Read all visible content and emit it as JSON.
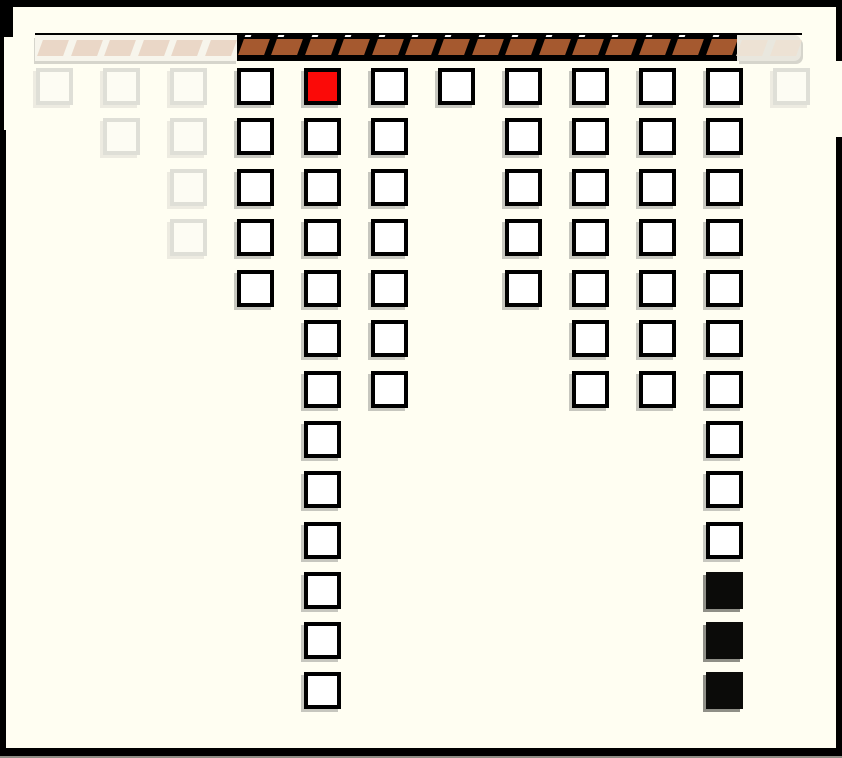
{
  "meta": {
    "description": "falling-blocks game board with brick ceiling, ghosted edge columns, one red block and three black blocks",
    "window_width": 842,
    "window_height": 758
  },
  "colors": {
    "background": "#FFFEF2",
    "frame": "#000000",
    "frame_bottom_edge": "#8E8E86",
    "bar_top_line": "#000000",
    "bar_background": "#000000",
    "brick": "#A5592F",
    "brick_highlight": "#FFFFFF",
    "ghost_bar_backing_left": "#F7F5EC",
    "ghost_bar_backing_right": "#E9E7DE",
    "ghost_slat_left": "#EAD7C7",
    "ghost_slat_right": "#EDE2D4",
    "ghost_shadow": "#D6D5CC",
    "block_border": "#000000",
    "block_white": "#FFFFFF",
    "block_red": "#FB0A08",
    "block_black": "#0B0B09",
    "ghost_block_border": "#DFDFD7",
    "ghost_block_fill": "#FDFCF3",
    "ghost_cell_shadow": "#EDEBE1",
    "block_shadow": "#C7C7BF",
    "black_block_shadow": "#8F8F87"
  },
  "bar": {
    "top_line": {
      "x": 35,
      "y": 33,
      "width": 767,
      "height": 2
    },
    "sections": [
      {
        "name": "brick-bar-ghost-left",
        "kind": "ghost-left",
        "x": 35,
        "y": 35,
        "width": 202,
        "height": 26,
        "slats": 6,
        "pitch": 33.5,
        "inset": 5
      },
      {
        "name": "brick-bar-solid",
        "kind": "solid",
        "x": 237,
        "y": 33,
        "width": 500,
        "height": 28,
        "slats": 15,
        "pitch": 33.4,
        "inset": 4
      },
      {
        "name": "brick-bar-ghost-right",
        "kind": "ghost-right",
        "x": 737,
        "y": 35,
        "width": 64,
        "height": 26,
        "slats": 2,
        "pitch": 33.5,
        "inset": 2
      }
    ]
  },
  "board": {
    "block_size": 37,
    "row_y": [
      68,
      118,
      169,
      219,
      270,
      320,
      371,
      421,
      471,
      522,
      572,
      622,
      672
    ],
    "columns": [
      {
        "x": 36,
        "ghost": true,
        "rows": [
          1
        ]
      },
      {
        "x": 103,
        "ghost": true,
        "rows": [
          1,
          2
        ]
      },
      {
        "x": 170,
        "ghost": true,
        "rows": [
          1,
          2,
          3,
          4
        ]
      },
      {
        "x": 237,
        "ghost": false,
        "rows": [
          1,
          2,
          3,
          4,
          5
        ]
      },
      {
        "x": 304,
        "ghost": false,
        "rows": [
          1,
          2,
          3,
          4,
          5,
          6,
          7,
          8,
          9,
          10,
          11,
          12,
          13
        ],
        "special": {
          "1": "red"
        }
      },
      {
        "x": 371,
        "ghost": false,
        "rows": [
          1,
          2,
          3,
          4,
          5,
          6,
          7
        ]
      },
      {
        "x": 438,
        "ghost": false,
        "rows": [
          1
        ]
      },
      {
        "x": 505,
        "ghost": false,
        "rows": [
          1,
          2,
          3,
          4,
          5
        ]
      },
      {
        "x": 572,
        "ghost": false,
        "rows": [
          1,
          2,
          3,
          4,
          5,
          6,
          7
        ]
      },
      {
        "x": 639,
        "ghost": false,
        "rows": [
          1,
          2,
          3,
          4,
          5,
          6,
          7
        ]
      },
      {
        "x": 706,
        "ghost": false,
        "rows": [
          1,
          2,
          3,
          4,
          5,
          6,
          7,
          8,
          9,
          10,
          11,
          12,
          13
        ],
        "special": {
          "11": "black",
          "12": "black",
          "13": "black"
        }
      },
      {
        "x": 773,
        "ghost": true,
        "rows": [
          1
        ]
      }
    ]
  },
  "frame": {
    "pieces": [
      {
        "name": "frame-top",
        "x": 0,
        "y": 0,
        "w": 842,
        "h": 7
      },
      {
        "name": "frame-left-corner",
        "x": 0,
        "y": 0,
        "w": 13,
        "h": 37
      },
      {
        "name": "frame-left-upper",
        "x": 0,
        "y": 0,
        "w": 4,
        "h": 137
      },
      {
        "name": "frame-left-lower",
        "x": 0,
        "y": 130,
        "w": 6,
        "h": 626
      },
      {
        "name": "frame-right-upper",
        "x": 836,
        "y": 7,
        "w": 6,
        "h": 54
      },
      {
        "name": "frame-right-lower",
        "x": 836,
        "y": 137,
        "w": 6,
        "h": 612
      },
      {
        "name": "frame-bottom",
        "x": 0,
        "y": 748,
        "w": 842,
        "h": 8
      }
    ],
    "bottom_edge": {
      "x": 0,
      "y": 756,
      "w": 842,
      "h": 2
    }
  }
}
